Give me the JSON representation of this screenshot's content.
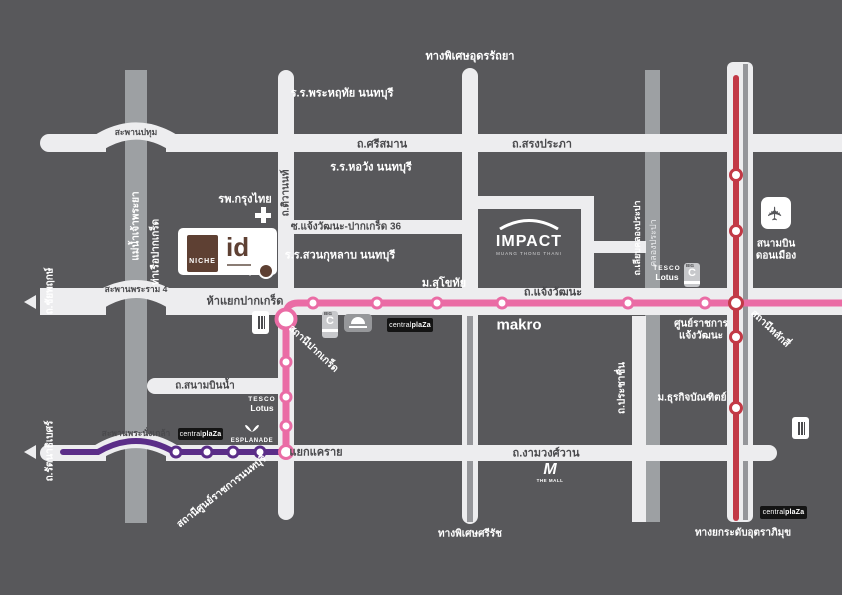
{
  "colors": {
    "bg": "#58585B",
    "road": "#EDEDEF",
    "water": "#9DA0A3",
    "ink": "#4A4A4D",
    "stripe": "#95969A",
    "pink": "#EA6CA5",
    "purple": "#5B2D88",
    "red": "#C23946",
    "brown": "#5E4033"
  },
  "labels": {
    "expwy_udon": "ทางพิเศษอุดรรัถยา",
    "school_phraharuthai": "ร.ร.พระหฤทัย นนทบุรี",
    "bridge_pathum": "สะพานปทุม",
    "srisaman": "ถ.ศรีสมาน",
    "songprapha": "ถ.สรงประภา",
    "school_horwang": "ร.ร.หอวัง นนทบุรี",
    "tiwanon": "ถ.ติวานนท์",
    "hospital": "รพ.กรุงไทย",
    "soi36": "ซ.แจ้งวัฒนะ-ปากเกร็ด 36",
    "school_suankularb": "ร.ร.สวนกุหลาบ นนทบุรี",
    "sukhothai": "ม.สุโขทัย",
    "river": "แม่น้ำเจ้าพระยา",
    "pier": "ท่าเรือปากเกร็ด",
    "chaiyapruek": "ถ.ชัยพฤกษ์",
    "bridge_rama4": "สะพานพระราม 4",
    "hayaek": "ห้าแยกปากเกร็ด",
    "chaengwattana": "ถ.แจ้งวัฒนะ",
    "st_pakkret": "สถานีปากเกร็ด",
    "civic_line1": "ศูนย์ราชการ",
    "civic_line2": "แจ้งวัฒนะ",
    "liabklong": "ถ.เลียบคลองประปา",
    "klongprapa": "คลองประปา",
    "airport_line1": "สนามบิน",
    "airport_line2": "ดอนเมือง",
    "st_laksi": "สถานีหลักสี่",
    "sanambinnam": "ถ.สนามบินน้ำ",
    "bridge_nangklao": "สะพานพระนั่งเกล้า",
    "rattanathibet": "ถ.รัตนาธิเบศร์",
    "st_civic": "สถานีศูนย์ราชการนนทบุรี",
    "khaerai": "แยกแคราย",
    "ngamwongwan": "ถ.งามวงศ์วาน",
    "srirat": "ทางพิเศษศรีรัช",
    "prachachuen": "ถ.ประชาชื่น",
    "dhurakij": "ม.ธุรกิจบัณฑิตย์",
    "uttaraphimuk": "ทางยกระดับอุตราภิมุข",
    "makro": "makro"
  },
  "logos": {
    "niche": {
      "name": "NICHE",
      "id": "id"
    },
    "impact": {
      "name": "IMPACT",
      "sub": "MUANG THONG THANI"
    },
    "tesco": {
      "line1": "TESCO",
      "line2": "Lotus"
    },
    "bigc": {
      "top": "BIG",
      "c": "C"
    },
    "central": {
      "part1": "central",
      "part2": "plaZa"
    },
    "esplanade": {
      "text": "ESPLANADE"
    },
    "themall": {
      "m": "M",
      "text": "THE MALL"
    }
  }
}
